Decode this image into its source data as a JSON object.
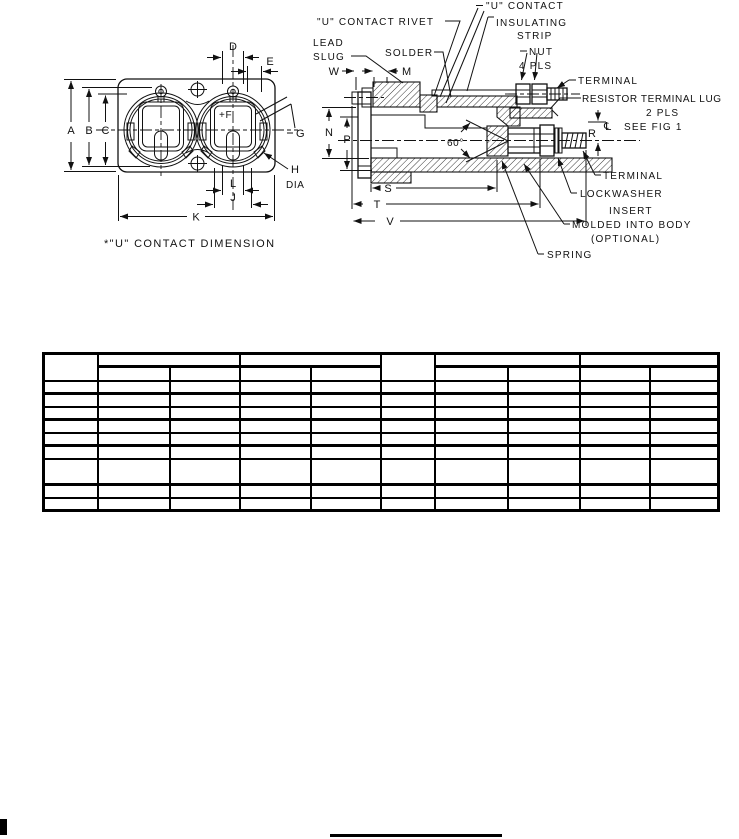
{
  "face_view": {
    "caption": "*\"U\" CONTACT DIMENSION",
    "dim_a": "A",
    "dim_b": "B",
    "dim_c": "C",
    "dim_d": "D",
    "dim_e": "E",
    "dim_f": "+F",
    "dim_g": "G",
    "dim_h": "H",
    "dim_h_dia": "DIA",
    "dim_l": "L",
    "dim_j": "J",
    "dim_k": "K"
  },
  "section_view": {
    "lbl_rivet": "\"U\" CONTACT RIVET",
    "lbl_contact": "\"U\" CONTACT",
    "lbl_insulating": "INSULATING",
    "lbl_strip": "STRIP",
    "lbl_lead": "LEAD",
    "lbl_slug": "SLUG",
    "lbl_solder": "SOLDER",
    "lbl_nut": "NUT",
    "lbl_nut_qty": "4 PLS",
    "lbl_terminal_top": "TERMINAL",
    "lbl_resistor_lug": "RESISTOR TERMINAL LUG",
    "lbl_resistor_qty": "2 PLS",
    "lbl_centerline": "℄",
    "lbl_see_fig": "SEE FIG 1",
    "lbl_terminal_bot": "TERMINAL",
    "lbl_lockwasher": "LOCKWASHER",
    "lbl_insert_1": "INSERT",
    "lbl_insert_2": "MOLDED INTO BODY",
    "lbl_insert_3": "(OPTIONAL)",
    "lbl_spring": "SPRING",
    "lbl_angle": "60°",
    "dim_w": "W",
    "dim_m": "M",
    "dim_n": "N",
    "dim_p": "P",
    "dim_r": "R",
    "dim_s": "S",
    "dim_t": "T",
    "dim_v": "V"
  },
  "table": {
    "corner_label": "",
    "group_labels": [
      "",
      "",
      "",
      ""
    ],
    "sub_labels": [
      "",
      "",
      "",
      "",
      "",
      "",
      "",
      ""
    ],
    "rows": [
      [
        "",
        "",
        "",
        "",
        "",
        "",
        "",
        "",
        "",
        ""
      ],
      [
        "",
        "",
        "",
        "",
        "",
        "",
        "",
        "",
        "",
        ""
      ],
      [
        "",
        "",
        "",
        "",
        "",
        "",
        "",
        "",
        "",
        ""
      ],
      [
        "",
        "",
        "",
        "",
        "",
        "",
        "",
        "",
        "",
        ""
      ],
      [
        "",
        "",
        "",
        "",
        "",
        "",
        "",
        "",
        "",
        ""
      ],
      [
        "",
        "",
        "",
        "",
        "",
        "",
        "",
        "",
        "",
        ""
      ],
      [
        "",
        "",
        "",
        "",
        "",
        "",
        "",
        "",
        "",
        ""
      ],
      [
        "",
        "",
        "",
        "",
        "",
        "",
        "",
        "",
        "",
        ""
      ],
      [
        "",
        "",
        "",
        "",
        "",
        "",
        "",
        "",
        "",
        ""
      ]
    ]
  }
}
